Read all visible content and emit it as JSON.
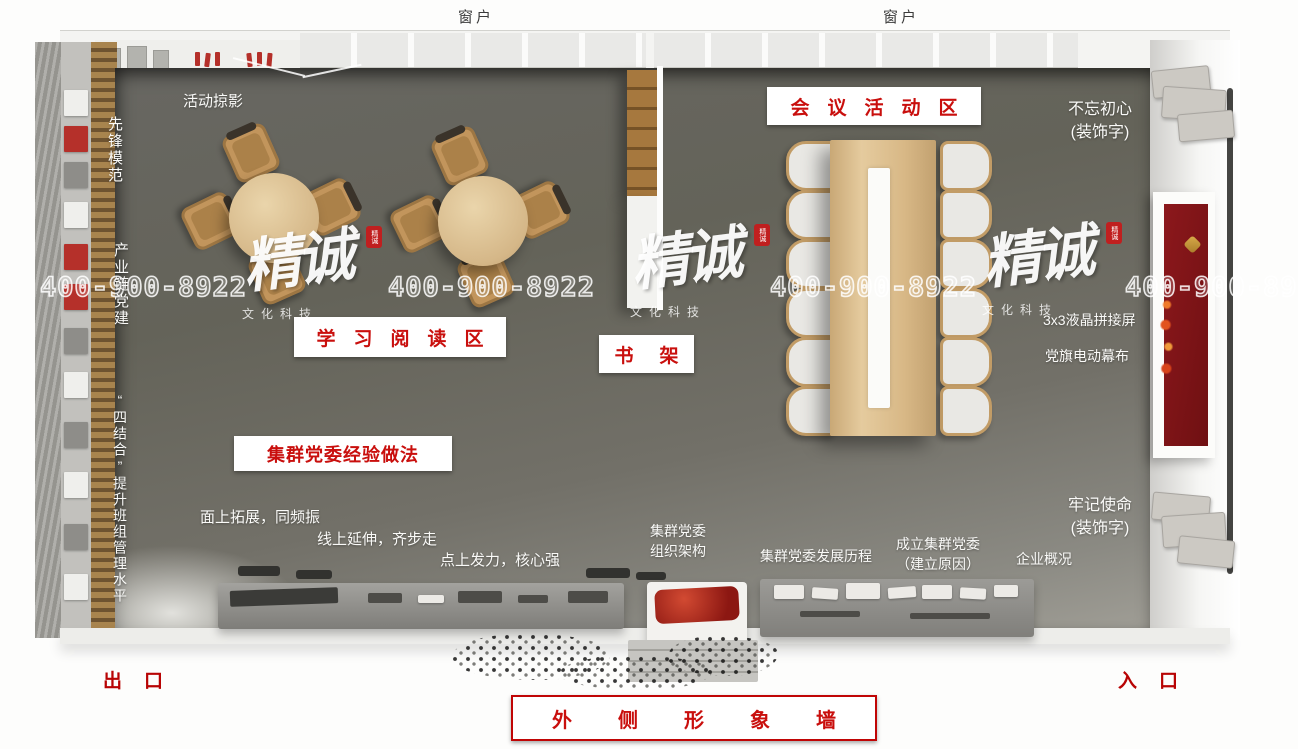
{
  "scene": {
    "windows": {
      "label": "窗户"
    },
    "top_left": {
      "activity": "活动掠影"
    },
    "left_wall": {
      "pioneer": "先锋模范",
      "industry": "产业链党建",
      "four_combine": "“四结合”提升班组管理水平"
    },
    "zones": {
      "reading": "学习阅读区",
      "meeting": "会议活动区",
      "bookshelf": "书架",
      "experience": "集群党委经验做法",
      "outer_wall": "外侧形象墙"
    },
    "slogans": [
      "面上拓展，同频振",
      "线上延伸，齐步走",
      "点上发力，核心强"
    ],
    "exhibit_labels": {
      "org": {
        "line1": "集群党委",
        "line2": "组织架构"
      },
      "history": "集群党委发展历程",
      "founding": {
        "line1": "成立集群党委",
        "line2": "（建立原因）"
      },
      "company": "企业概况"
    },
    "right_wall": {
      "motto_top": {
        "line1": "不忘初心",
        "line2": "(装饰字)"
      },
      "screen": "3x3液晶拼接屏",
      "curtain": "党旗电动幕布",
      "motto_bottom": {
        "line1": "牢记使命",
        "line2": "(装饰字)"
      }
    },
    "doors": {
      "exit": "出口",
      "entrance": "入口"
    }
  },
  "watermark": {
    "brand": "精诚",
    "brand_sub": "文化科技",
    "phone": "400-900-8922",
    "seal_text": "精诚"
  },
  "colors": {
    "accent_red": "#c00505",
    "zone_text_red": "#c90f0d",
    "floor_grey": "#686762",
    "wood_light": "#d8bd92",
    "wood_dark": "#a6783e",
    "flag_red": "#8c181c"
  }
}
